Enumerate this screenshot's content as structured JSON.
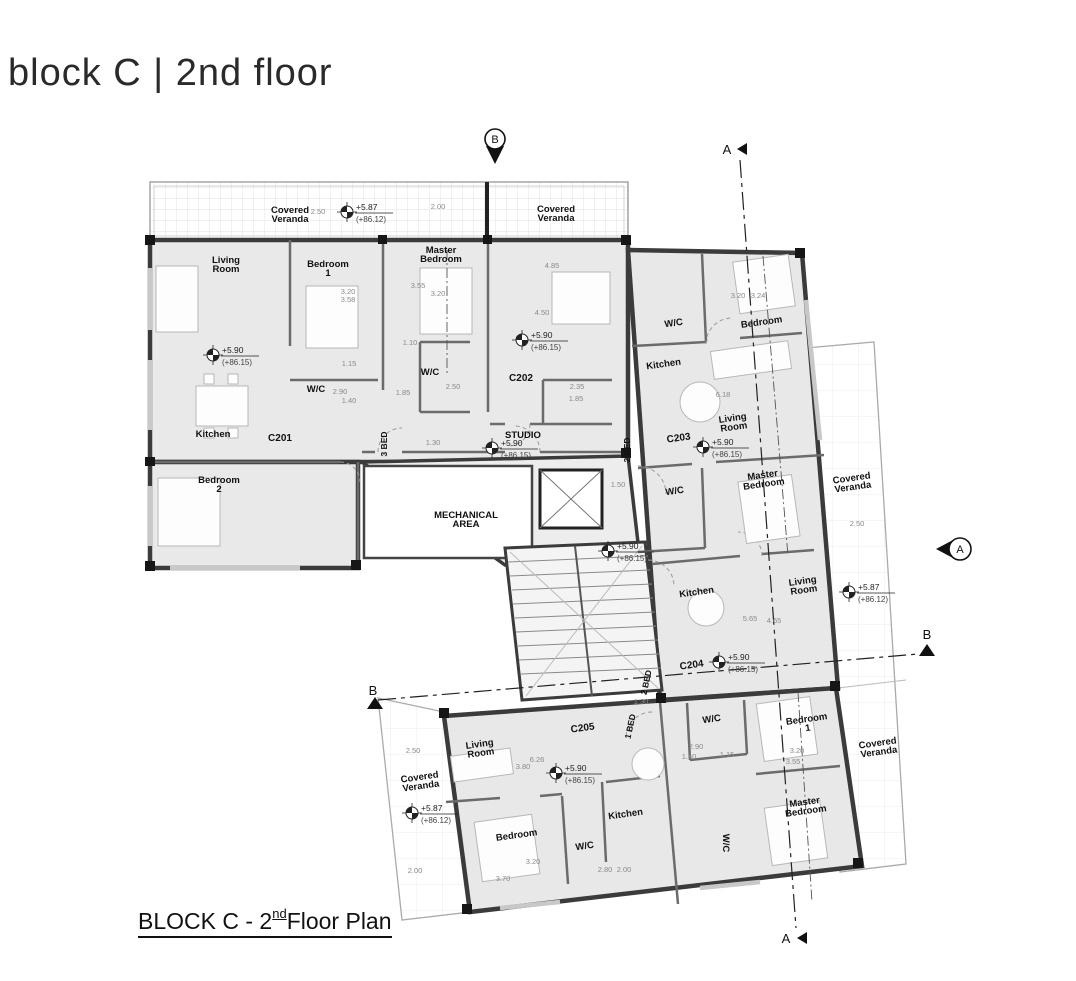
{
  "page": {
    "title": "block C | 2nd floor"
  },
  "caption": {
    "prefix": "BLOCK C - 2",
    "sup": "nd",
    "suffix": " Floor Plan"
  },
  "plan": {
    "unit_labels": [
      {
        "t": "C201",
        "x": 280,
        "y": 441
      },
      {
        "t": "C202",
        "x": 521,
        "y": 381
      },
      {
        "t": "C203",
        "x": 679,
        "y": 441,
        "rot": -8
      },
      {
        "t": "C204",
        "x": 692,
        "y": 668,
        "rot": -8
      },
      {
        "t": "C205",
        "x": 583,
        "y": 731,
        "rot": -8
      }
    ],
    "room_labels": [
      {
        "lines": [
          "Living",
          "Room"
        ],
        "x": 226,
        "y": 263
      },
      {
        "lines": [
          "Bedroom",
          "1"
        ],
        "x": 328,
        "y": 267
      },
      {
        "lines": [
          "Master",
          "Bedroom"
        ],
        "x": 441,
        "y": 253
      },
      {
        "lines": [
          "W/C"
        ],
        "x": 316,
        "y": 392
      },
      {
        "lines": [
          "W/C"
        ],
        "x": 430,
        "y": 375
      },
      {
        "lines": [
          "Kitchen"
        ],
        "x": 213,
        "y": 437
      },
      {
        "lines": [
          "Bedroom",
          "2"
        ],
        "x": 219,
        "y": 483
      },
      {
        "lines": [
          "STUDIO"
        ],
        "x": 523,
        "y": 438
      },
      {
        "lines": [
          "MECHANICAL",
          "AREA"
        ],
        "x": 466,
        "y": 518
      },
      {
        "lines": [
          "W/C"
        ],
        "x": 674,
        "y": 326,
        "rot": -8
      },
      {
        "lines": [
          "Bedroom"
        ],
        "x": 762,
        "y": 325,
        "rot": -8
      },
      {
        "lines": [
          "Kitchen"
        ],
        "x": 664,
        "y": 367,
        "rot": -8
      },
      {
        "lines": [
          "Living",
          "Room"
        ],
        "x": 733,
        "y": 421,
        "rot": -8
      },
      {
        "lines": [
          "W/C"
        ],
        "x": 675,
        "y": 494,
        "rot": -8
      },
      {
        "lines": [
          "Master",
          "Bedroom"
        ],
        "x": 763,
        "y": 478,
        "rot": -8
      },
      {
        "lines": [
          "Kitchen"
        ],
        "x": 697,
        "y": 595,
        "rot": -8
      },
      {
        "lines": [
          "Living",
          "Room"
        ],
        "x": 803,
        "y": 584,
        "rot": -8
      },
      {
        "lines": [
          "W/C"
        ],
        "x": 712,
        "y": 722,
        "rot": -8
      },
      {
        "lines": [
          "Bedroom",
          "1"
        ],
        "x": 807,
        "y": 722,
        "rot": -8
      },
      {
        "lines": [
          "Master",
          "Bedroom"
        ],
        "x": 805,
        "y": 805,
        "rot": -8
      },
      {
        "lines": [
          "W/C"
        ],
        "x": 723,
        "y": 843,
        "rot": 90
      },
      {
        "lines": [
          "Living",
          "Room"
        ],
        "x": 480,
        "y": 747,
        "rot": -8
      },
      {
        "lines": [
          "Bedroom"
        ],
        "x": 517,
        "y": 838,
        "rot": -8
      },
      {
        "lines": [
          "Kitchen"
        ],
        "x": 626,
        "y": 817,
        "rot": -8
      },
      {
        "lines": [
          "W/C"
        ],
        "x": 585,
        "y": 849,
        "rot": -8
      }
    ],
    "veranda_labels": [
      {
        "lines": [
          "Covered",
          "Veranda"
        ],
        "x": 290,
        "y": 213
      },
      {
        "lines": [
          "Covered",
          "Veranda"
        ],
        "x": 556,
        "y": 212
      },
      {
        "lines": [
          "Covered",
          "Veranda"
        ],
        "x": 852,
        "y": 481,
        "rot": -8
      },
      {
        "lines": [
          "Covered",
          "Veranda"
        ],
        "x": 878,
        "y": 746,
        "rot": -8
      },
      {
        "lines": [
          "Covered",
          "Veranda"
        ],
        "x": 420,
        "y": 780,
        "rot": -8
      }
    ],
    "bed_labels": [
      {
        "t": "3 BED",
        "x": 387,
        "y": 444,
        "rot": -90
      },
      {
        "t": "2 BED",
        "x": 630,
        "y": 450,
        "rot": -90
      },
      {
        "t": "2 BED",
        "x": 649,
        "y": 683,
        "rot": -78
      },
      {
        "t": "1 BED",
        "x": 633,
        "y": 727,
        "rot": -78
      }
    ],
    "elevation_markers": [
      {
        "x": 213,
        "y": 355,
        "level": "+5.90",
        "datum": "(+86.15)"
      },
      {
        "x": 522,
        "y": 340,
        "level": "+5.90",
        "datum": "(+86.15)"
      },
      {
        "x": 492,
        "y": 448,
        "level": "+5.90",
        "datum": "(+86.15)"
      },
      {
        "x": 608,
        "y": 551,
        "level": "+5.90",
        "datum": "(+86.15)"
      },
      {
        "x": 703,
        "y": 447,
        "level": "+5.90",
        "datum": "(+86.15)"
      },
      {
        "x": 719,
        "y": 662,
        "level": "+5.90",
        "datum": "(+86.15)"
      },
      {
        "x": 556,
        "y": 773,
        "level": "+5.90",
        "datum": "(+86.15)"
      },
      {
        "x": 347,
        "y": 212,
        "level": "+5.87",
        "datum": "(+86.12)"
      },
      {
        "x": 849,
        "y": 592,
        "level": "+5.87",
        "datum": "(+86.12)"
      },
      {
        "x": 412,
        "y": 813,
        "level": "+5.87",
        "datum": "(+86.12)"
      }
    ],
    "dim_labels": [
      {
        "t": "2.50",
        "x": 318,
        "y": 214
      },
      {
        "t": "2.00",
        "x": 438,
        "y": 209
      },
      {
        "t": "3.20",
        "x": 348,
        "y": 294
      },
      {
        "t": "3.58",
        "x": 348,
        "y": 302
      },
      {
        "t": "3.55",
        "x": 418,
        "y": 288
      },
      {
        "t": "3.20",
        "x": 438,
        "y": 296
      },
      {
        "t": "4.85",
        "x": 552,
        "y": 268
      },
      {
        "t": "4.50",
        "x": 542,
        "y": 315
      },
      {
        "t": "1.10",
        "x": 410,
        "y": 345
      },
      {
        "t": "1.15",
        "x": 349,
        "y": 366
      },
      {
        "t": "2.90",
        "x": 340,
        "y": 394
      },
      {
        "t": "1.40",
        "x": 349,
        "y": 403
      },
      {
        "t": "1.85",
        "x": 403,
        "y": 395
      },
      {
        "t": "2.50",
        "x": 453,
        "y": 389
      },
      {
        "t": "2.35",
        "x": 577,
        "y": 389
      },
      {
        "t": "1.85",
        "x": 576,
        "y": 401
      },
      {
        "t": "1.30",
        "x": 433,
        "y": 445
      },
      {
        "t": "3.20",
        "x": 738,
        "y": 298
      },
      {
        "t": "3.24",
        "x": 758,
        "y": 298
      },
      {
        "t": "6.18",
        "x": 723,
        "y": 397
      },
      {
        "t": "1.50",
        "x": 618,
        "y": 487
      },
      {
        "t": "2.50",
        "x": 857,
        "y": 526
      },
      {
        "t": "5.65",
        "x": 750,
        "y": 621
      },
      {
        "t": "4.65",
        "x": 774,
        "y": 623
      },
      {
        "t": "6.26",
        "x": 537,
        "y": 762
      },
      {
        "t": "3.80",
        "x": 523,
        "y": 769
      },
      {
        "t": "2.50",
        "x": 413,
        "y": 753
      },
      {
        "t": "2.00",
        "x": 415,
        "y": 873
      },
      {
        "t": "2.90",
        "x": 696,
        "y": 749
      },
      {
        "t": "1.40",
        "x": 689,
        "y": 759
      },
      {
        "t": "1.15",
        "x": 727,
        "y": 757
      },
      {
        "t": "3.20",
        "x": 797,
        "y": 753
      },
      {
        "t": "3.55",
        "x": 793,
        "y": 764
      },
      {
        "t": "3.20",
        "x": 533,
        "y": 864
      },
      {
        "t": "3.70",
        "x": 503,
        "y": 881
      },
      {
        "t": "2.80",
        "x": 605,
        "y": 872
      },
      {
        "t": "2.00",
        "x": 624,
        "y": 872
      },
      {
        "t": "1.30",
        "x": 641,
        "y": 704
      }
    ],
    "section_markers": {
      "b_top": {
        "label": "B",
        "x": 495,
        "y": 140
      },
      "a_top": {
        "label": "A",
        "x": 727,
        "y": 149
      },
      "a_right": {
        "label": "A",
        "x": 960,
        "y": 549
      },
      "b_right": {
        "label": "B",
        "x": 927,
        "y": 634
      },
      "b_left": {
        "label": "B",
        "x": 373,
        "y": 690
      },
      "a_bottom": {
        "label": "A",
        "x": 786,
        "y": 938
      }
    }
  }
}
